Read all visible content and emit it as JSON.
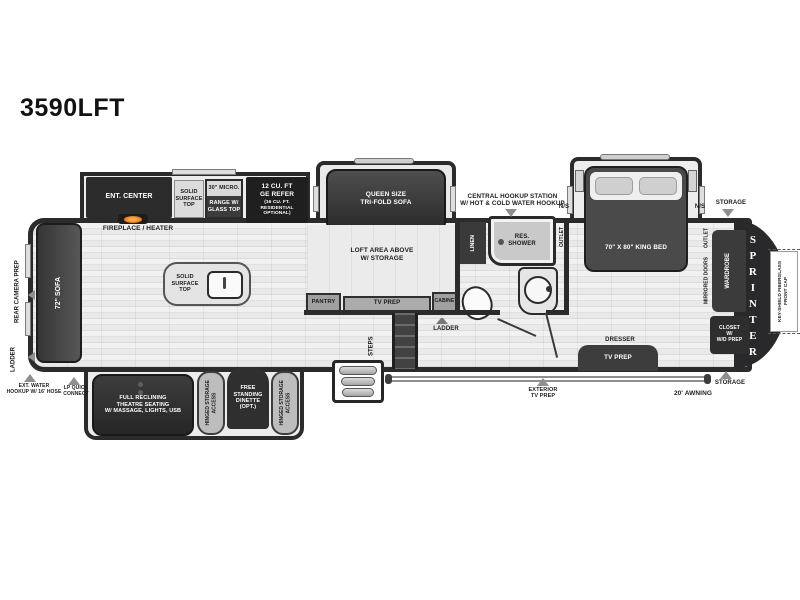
{
  "title": "3590LFT",
  "brand": "SPRINTER",
  "colors": {
    "wall": "#2b2b2b",
    "flame": "#e8741f",
    "arrow": "#8f8f8f",
    "floor": "#e9e9e9"
  },
  "exterior": {
    "rear_camera_prep": "REAR CAMERA PREP",
    "ladder": "LADDER",
    "ext_water": "EXT. WATER\nHOOKUP W/ 16' HOSE",
    "lp_quick_connect": "LP QUICK\nCONNECT",
    "central_hookup": "CENTRAL HOOKUP STATION\nW/ HOT & COLD WATER HOOKUP",
    "storage_top": "STORAGE",
    "storage_bottom": "STORAGE",
    "awning": "20'  AWNING",
    "exterior_tv_prep": "EXTERIOR\nTV PREP",
    "front_cap": "KEY-SHIELD FIBERGLASS\nFRONT CAP"
  },
  "living": {
    "sofa": "72\" SOFA",
    "ent_center": "ENT. CENTER",
    "fireplace": "FIREPLACE / HEATER",
    "island_top": "SOLID\nSURFACE\nTOP",
    "theatre": "FULL RECLINING\nTHEATRE SEATING\nW/ MASSAGE, LIGHTS, USB",
    "hinged_storage_left": "HINGED STORAGE\nACCESS",
    "hinged_storage_right": "HINGED STORAGE\nACCESS",
    "dinette": "FREE\nSTANDING\nDINETTE\n(OPT.)"
  },
  "kitchen": {
    "counter": "SOLID\nSURFACE\nTOP",
    "micro": "30\" MICRO.",
    "range": "RANGE W/\nGLASS TOP",
    "refer": "12 CU. FT\nGE REFER",
    "refer_note": "(16 CU. FT.\nRESIDENTIAL\nOPTIONAL)",
    "pantry": "PANTRY"
  },
  "loft": {
    "queen_sofa": "QUEEN SIZE\nTRI-FOLD SOFA",
    "loft_area": "LOFT AREA ABOVE\nW/ STORAGE",
    "tv_prep": "TV PREP",
    "cabinet": "CABINET",
    "ladder": "LADDER",
    "steps": "STEPS"
  },
  "bath": {
    "linen": "LINEN",
    "shower": "RES.\nSHOWER",
    "outlet": "OUTLET"
  },
  "bedroom": {
    "king_bed": "70\" X 80\" KING BED",
    "ns_left": "N/S",
    "ns_right": "N/S",
    "outlet": "OUTLET",
    "mirrored_doors": "MIRRORED DOORS",
    "wardrobe": "WARDROBE",
    "closet": "CLOSET\nW/\nW/D PREP",
    "dresser": "DRESSER",
    "tv_prep": "TV PREP"
  }
}
